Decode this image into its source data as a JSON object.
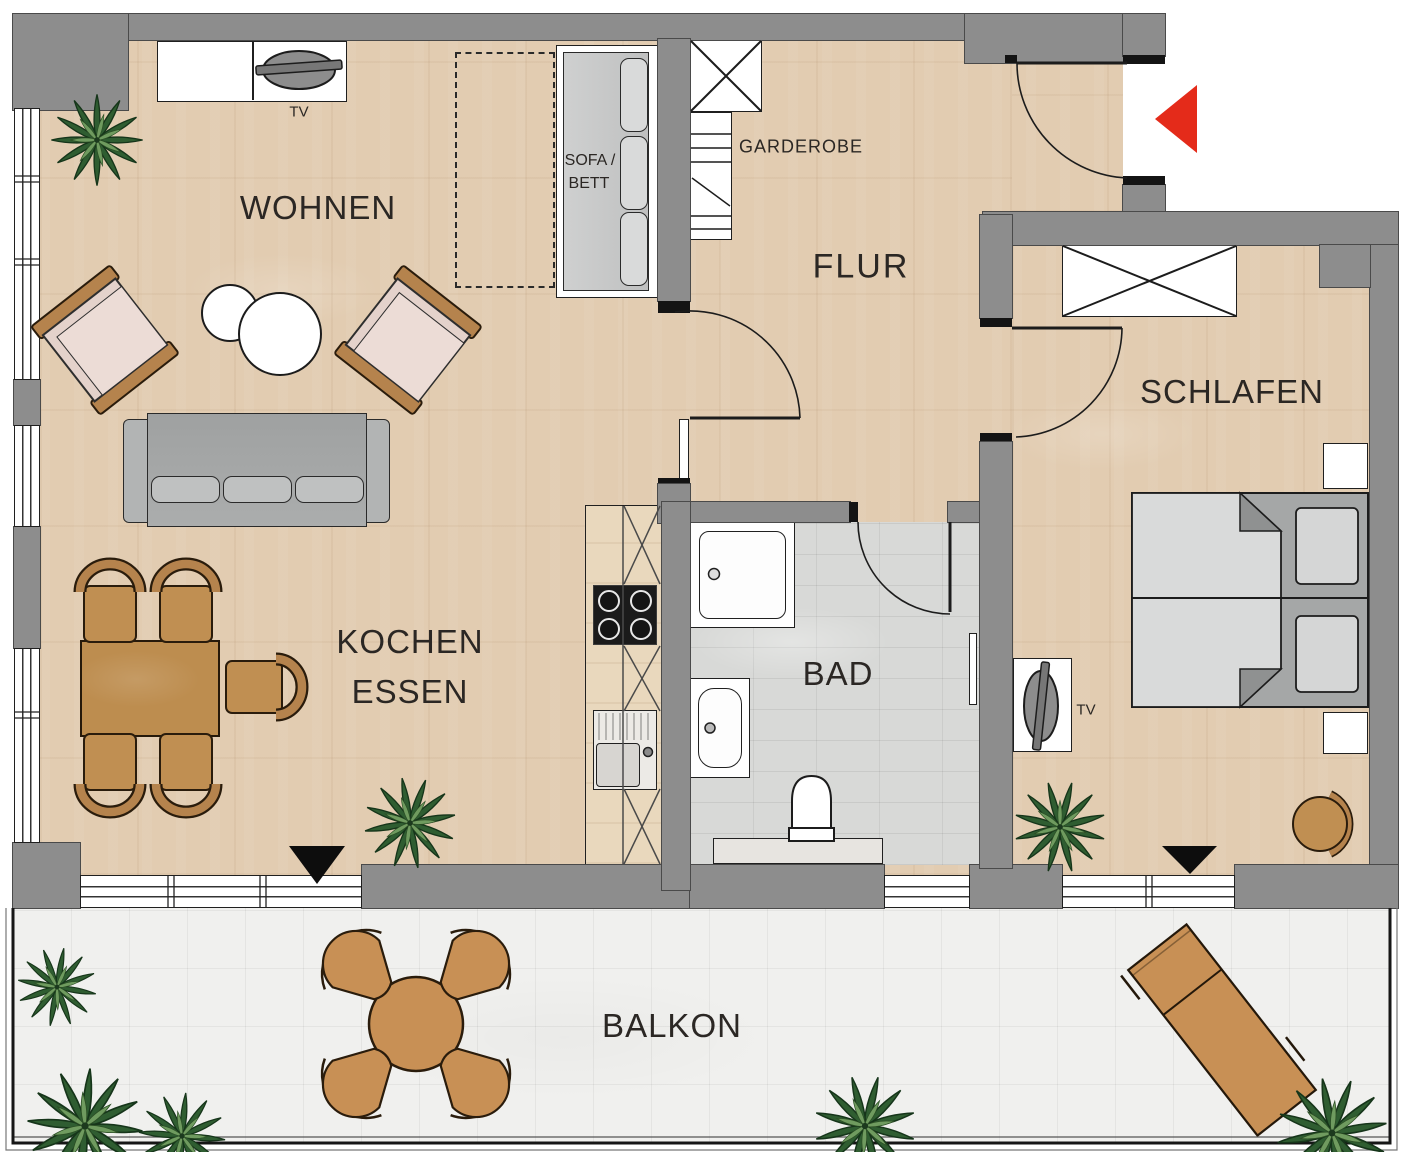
{
  "rooms": {
    "living": {
      "label": "WOHNEN"
    },
    "hall": {
      "label": "FLUR"
    },
    "bedroom": {
      "label": "SCHLAFEN"
    },
    "kitchen_dining": {
      "label_line1": "KOCHEN",
      "label_line2": "ESSEN"
    },
    "bath": {
      "label": "BAD"
    },
    "balcony": {
      "label": "BALKON"
    }
  },
  "features": {
    "wardrobe": {
      "label": "GARDEROBE"
    },
    "sofa_bed": {
      "label_line1": "SOFA /",
      "label_line2": "BETT"
    },
    "tv_living": {
      "label": "TV"
    },
    "tv_bedroom": {
      "label": "TV"
    }
  },
  "colors": {
    "wall": "#8d8d8d",
    "wood_floor": "#e2ccb1",
    "bath_tile": "#d8d9d7",
    "balcony_tile": "#f0f0ee",
    "entrance_arrow_red": "#e42b1a",
    "furniture_wood": "#c08f52",
    "sofa_gray": "#a9abab",
    "plant_green": "#2f5d31"
  }
}
